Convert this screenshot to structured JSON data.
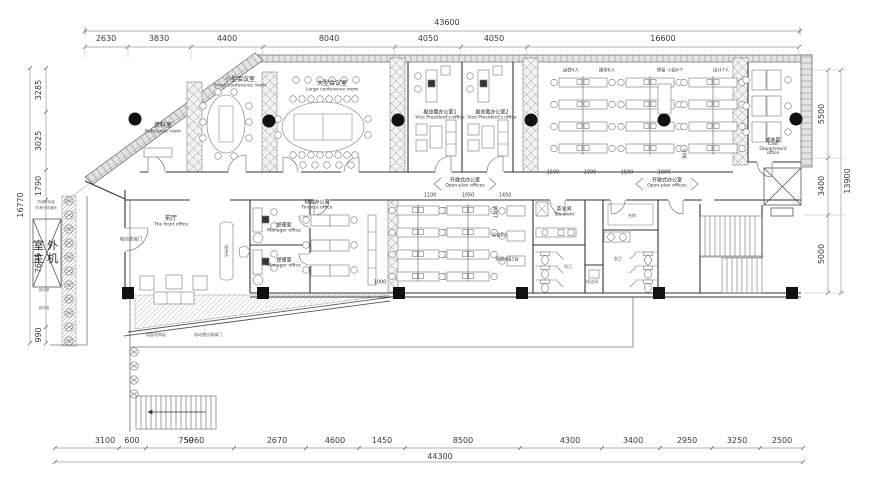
{
  "dims": {
    "top_total": "43600",
    "top": [
      "2630",
      "3830",
      "4400",
      "8040",
      "4050",
      "4050",
      "16600"
    ],
    "left_total": "16770",
    "left": [
      "3285",
      "3025",
      "1790",
      "7675",
      "990"
    ],
    "right_total": "13900",
    "right": [
      "5500",
      "3400",
      "5000"
    ],
    "bottom_total": "44300",
    "bottom": [
      "3100",
      "600",
      "750",
      "5960",
      "2670",
      "4600",
      "1450",
      "8500",
      "4300",
      "3400",
      "2950",
      "3250",
      "2500"
    ],
    "inner_top": [
      "1500",
      "1000",
      "1500",
      "1000"
    ],
    "inner_mid": [
      "1100",
      "1050",
      "1450"
    ],
    "inner_v1": "900",
    "inner_v2": "1200",
    "inner_h1": "1000"
  },
  "rooms": {
    "reference": {
      "zh": "资料室",
      "en": "Reference room"
    },
    "small_conf": {
      "zh": "小型会议室",
      "en": "Small conference room"
    },
    "large_conf": {
      "zh": "大型会议室",
      "en": "Large conference room"
    },
    "vp1": {
      "zh": "副总裁办公室1",
      "en": "Vice President's office"
    },
    "vp2": {
      "zh": "副总裁办公室2",
      "en": "Vice President's office"
    },
    "open1": {
      "zh": "开敞式办公室",
      "en": "Open-plan offices"
    },
    "open2": {
      "zh": "开敞式办公室",
      "en": "Open-plan offices"
    },
    "cost": {
      "zh": "成本部",
      "en": "Cost Department office"
    },
    "front": {
      "zh": "前厅",
      "en": "The front office"
    },
    "manager1": {
      "zh": "经理室",
      "en": "Manager office"
    },
    "manager2": {
      "zh": "经理室",
      "en": "Manager office"
    },
    "finance": {
      "zh": "财务办公室",
      "en": "Finance office"
    },
    "tea": {
      "zh": "茶水间",
      "en": "Tea room"
    },
    "male_wc": {
      "zh": "男卫"
    },
    "female_wc": {
      "zh": "女卫"
    },
    "cleaning": {
      "zh": "保洁间"
    },
    "storage": {
      "zh": "仓库"
    }
  },
  "teams": {
    "ops": "运营4人",
    "media": "媒体6人",
    "reserve": "预留 小组4个",
    "design": "设计7人",
    "general": "综合8人",
    "reserve2": "预留4组1台"
  },
  "labels": {
    "outdoor_unit_line1": "室外",
    "outdoor_unit_line2": "主机",
    "electric_door": "电动玻璃门",
    "auto_door": "电动感应玻璃门",
    "paving": "烧面花岗岩",
    "reception_desk": "接待台",
    "note1": "同地坪标高",
    "note2": "防滑石材铺地",
    "green1": "绿化带",
    "green2": "绿化带"
  }
}
